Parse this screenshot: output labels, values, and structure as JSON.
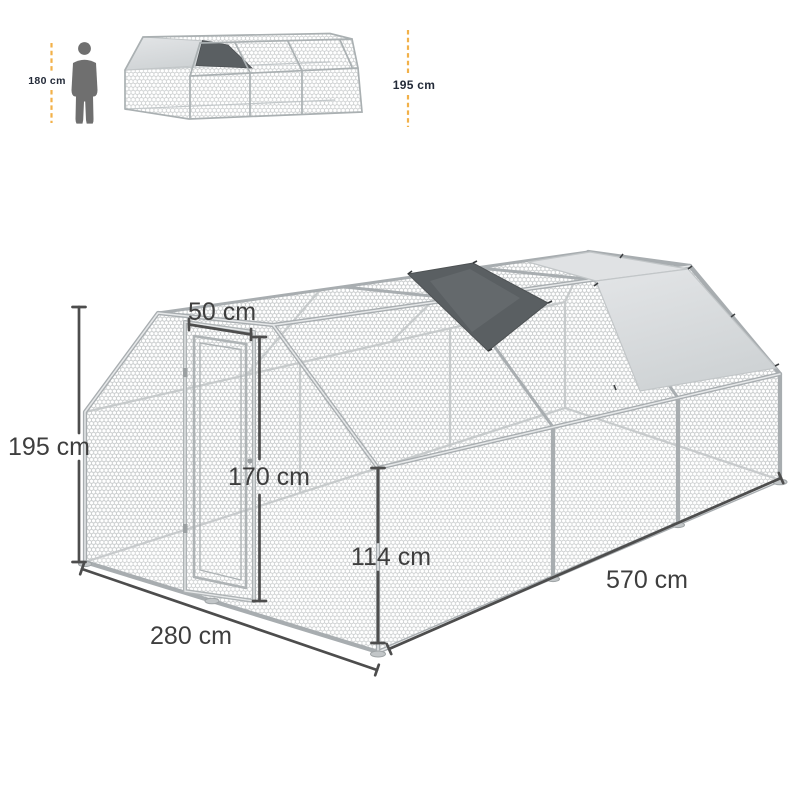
{
  "size_comparison": {
    "person_height": "180 cm",
    "structure_height": "195 cm"
  },
  "dimensions": {
    "door_width": "50 cm",
    "door_height": "170 cm",
    "side_wall_height": "114 cm",
    "overall_height": "195 cm",
    "overall_width": "280 cm",
    "overall_length": "570 cm"
  },
  "colors": {
    "accent_yellow": "#F2B149",
    "dimension_line": "#4D4D4D",
    "dimension_text": "#3E3E3E",
    "comparison_text": "#232A38",
    "silhouette": "#6F6F6F",
    "mesh": "#C7CACB",
    "frame": "#A8ADB0",
    "tarp_light": "#D8DBDD",
    "tarp_dark": "#5A5F62",
    "background": "#FFFFFF"
  }
}
